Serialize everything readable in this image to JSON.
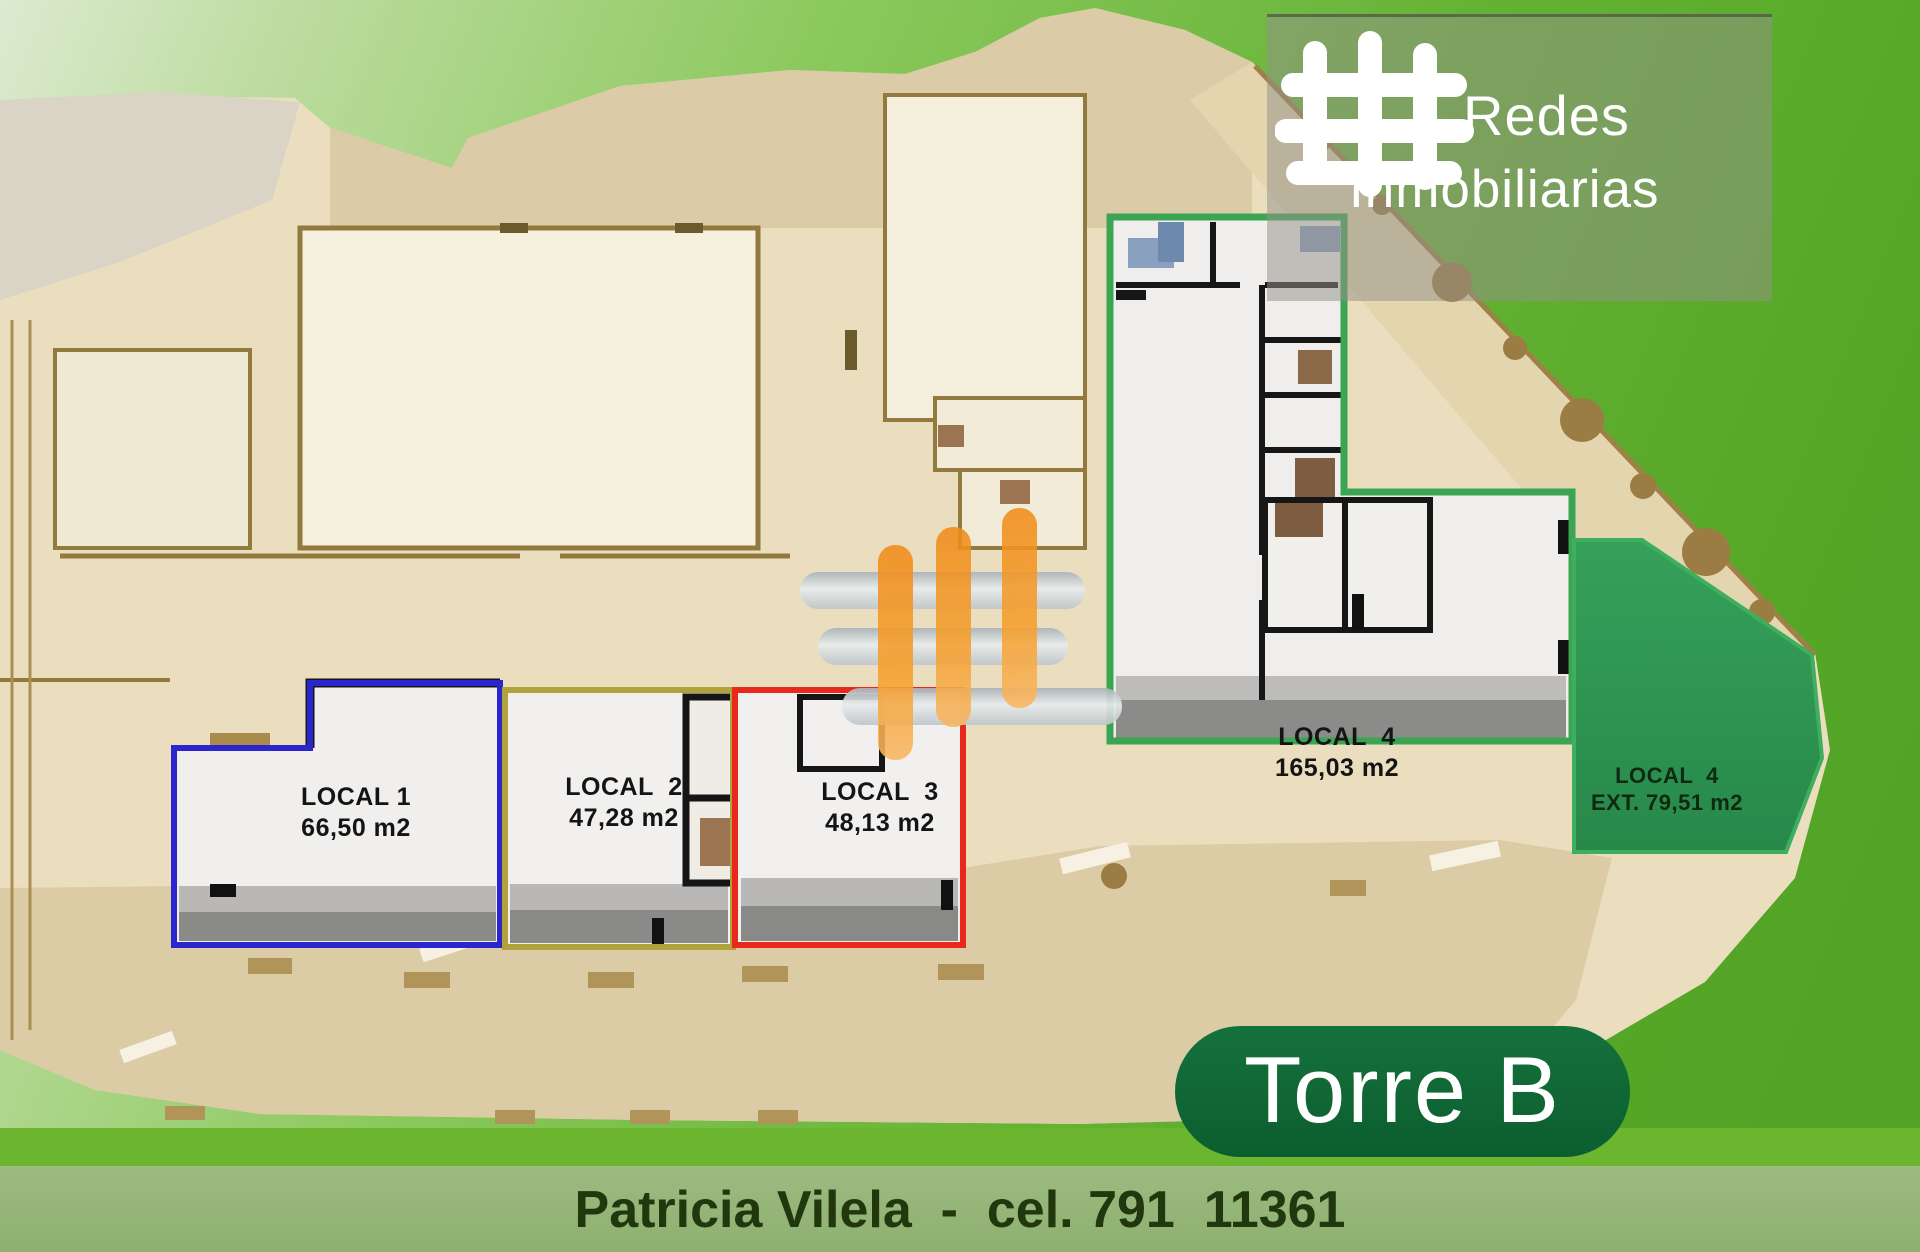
{
  "brand": {
    "line1": "Redes",
    "line2": "Inmobiliarias",
    "logo_icon": "hash-grid-icon",
    "panel_color": "rgba(148,146,136,0.52)"
  },
  "watermark": {
    "icon": "hash-grid-watermark",
    "orange": "#f59d2a",
    "silver": "#d6dcdf"
  },
  "tower_badge": "Torre B",
  "tower_badge_color": "#0e6433",
  "contact": {
    "name": "Patricia Vilela",
    "separator": "  -  ",
    "phone": "cel. 791  11361"
  },
  "locals": [
    {
      "id": "local-1",
      "name": "LOCAL 1",
      "area": "66,50 m2",
      "outline_color": "#2a25cc"
    },
    {
      "id": "local-2",
      "name": "LOCAL  2",
      "area": "47,28 m2",
      "outline_color": "#b2a23c"
    },
    {
      "id": "local-3",
      "name": "LOCAL  3",
      "area": "48,13 m2",
      "outline_color": "#e8271d"
    },
    {
      "id": "local-4",
      "name": "LOCAL  4",
      "area": "165,03 m2",
      "outline_color": "#3ba554"
    },
    {
      "id": "local-4-ext",
      "name": "LOCAL  4",
      "area": "EXT. 79,51 m2",
      "fill_color": "#2e9150"
    }
  ],
  "plan_colors": {
    "building_fill": "#eadebf",
    "wall": "#8f7a3e",
    "terrace": "#dbcca6",
    "background_green": "#5aab2b",
    "bottom_band": "#6cb52f",
    "bottom_strip": "#97b77b"
  }
}
